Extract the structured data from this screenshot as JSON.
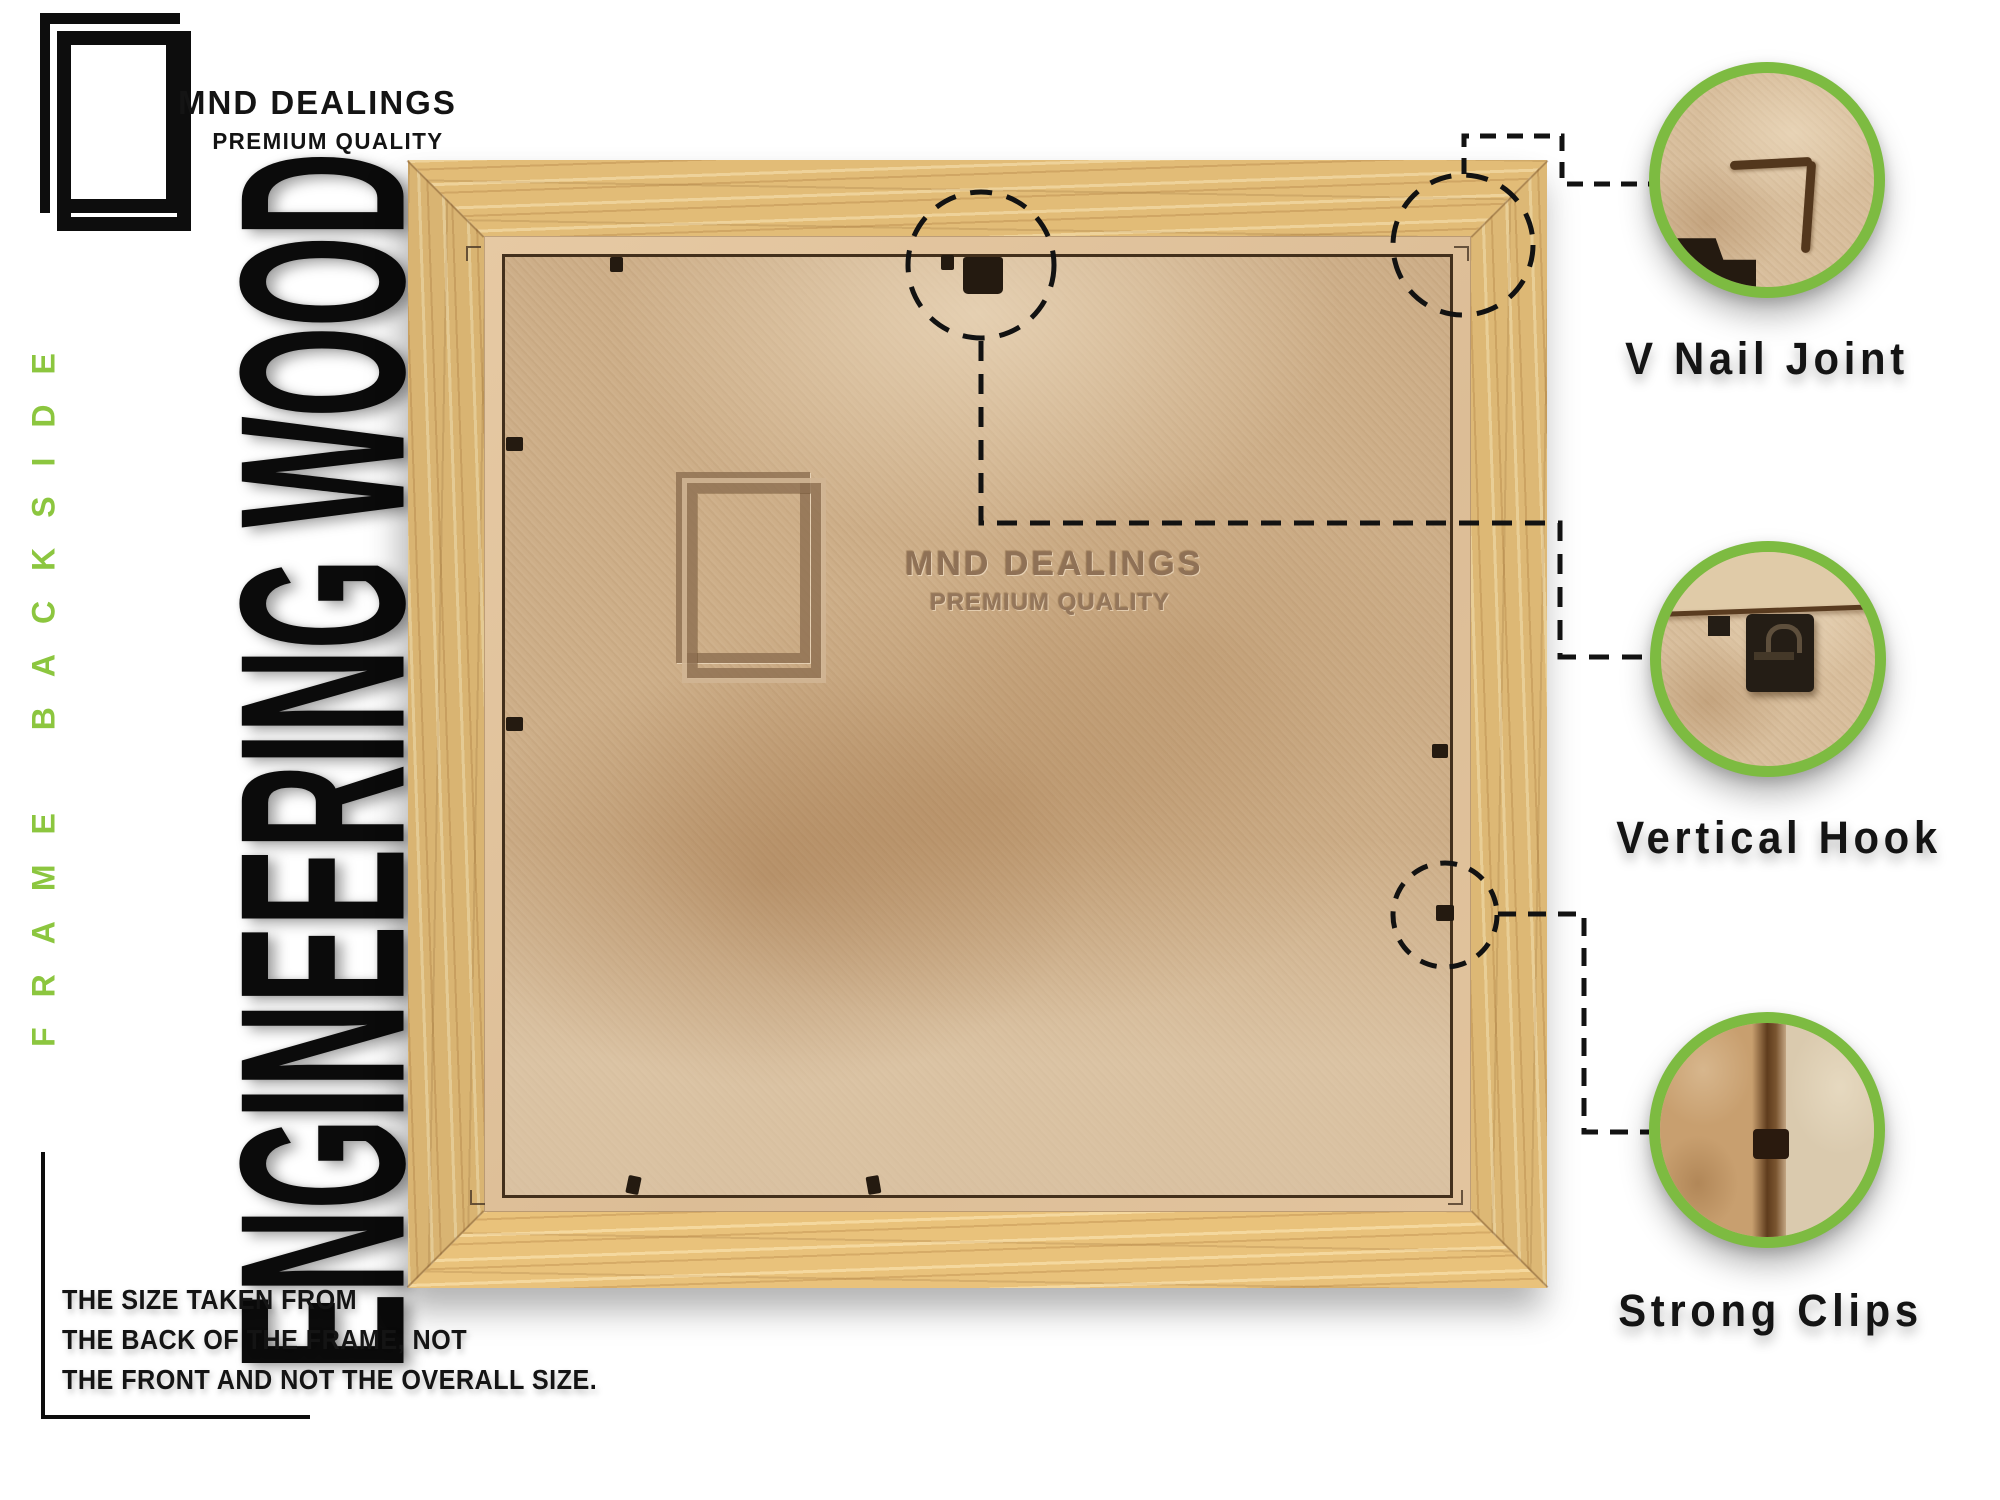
{
  "brand": {
    "name": "MND DEALINGS",
    "tagline": "PREMIUM QUALITY"
  },
  "side_label": "FRAME BACKSIDE",
  "material_label": "ENGINEERING WOOD",
  "watermark": {
    "name": "MND DEALINGS",
    "tagline": "PREMIUM QUALITY"
  },
  "callouts": [
    {
      "label": "V Nail Joint"
    },
    {
      "label": "Vertical Hook"
    },
    {
      "label": "Strong Clips"
    }
  ],
  "disclaimer": {
    "lines": [
      "THE SIZE TAKEN FROM",
      "THE BACK OF THE FRAME, NOT",
      "THE FRONT AND NOT THE OVERALL SIZE."
    ]
  },
  "colors": {
    "accent_green": "#7DBB41",
    "side_label_green": "#8CC63F",
    "text_black": "#141414",
    "wood": "#E2BC77",
    "lip_tan": "#DFC09A",
    "mdf": "#CDAE88",
    "watermark_brown": "#8F7156"
  }
}
